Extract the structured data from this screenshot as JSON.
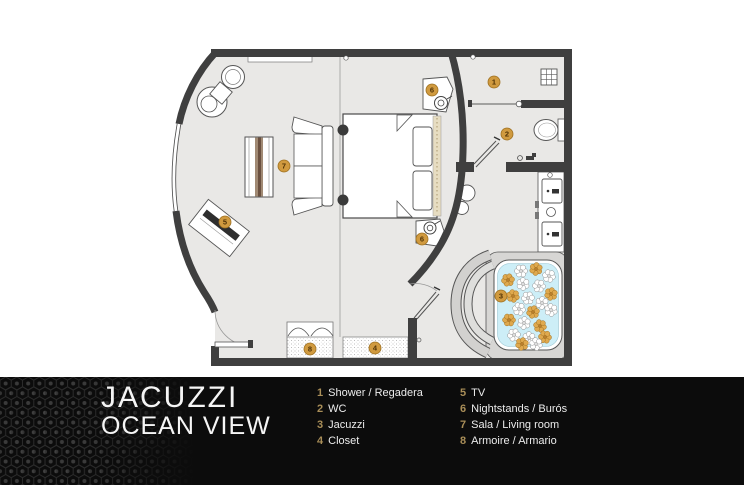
{
  "title": {
    "line1": "JACUZZI",
    "line2": "OCEAN VIEW"
  },
  "legend": {
    "col1": [
      {
        "num": "1",
        "label": "Shower / Regadera"
      },
      {
        "num": "2",
        "label": "WC"
      },
      {
        "num": "3",
        "label": "Jacuzzi"
      },
      {
        "num": "4",
        "label": "Closet"
      }
    ],
    "col2": [
      {
        "num": "5",
        "label": "TV"
      },
      {
        "num": "6",
        "label": "Nightstands / Burós"
      },
      {
        "num": "7",
        "label": "Sala / Living room"
      },
      {
        "num": "8",
        "label": "Armoire / Armario"
      }
    ]
  },
  "plan": {
    "markers": [
      {
        "num": "1",
        "name": "shower"
      },
      {
        "num": "2",
        "name": "wc"
      },
      {
        "num": "3",
        "name": "jacuzzi"
      },
      {
        "num": "4",
        "name": "closet"
      },
      {
        "num": "5",
        "name": "tv"
      },
      {
        "num": "6",
        "name": "nightstand-top"
      },
      {
        "num": "6",
        "name": "nightstand-bottom"
      },
      {
        "num": "7",
        "name": "living-room"
      },
      {
        "num": "8",
        "name": "armoire"
      }
    ],
    "colors": {
      "accent_gold": "#d09a3f",
      "water": "#cdeef7",
      "wall": "#3f3f3f"
    }
  }
}
